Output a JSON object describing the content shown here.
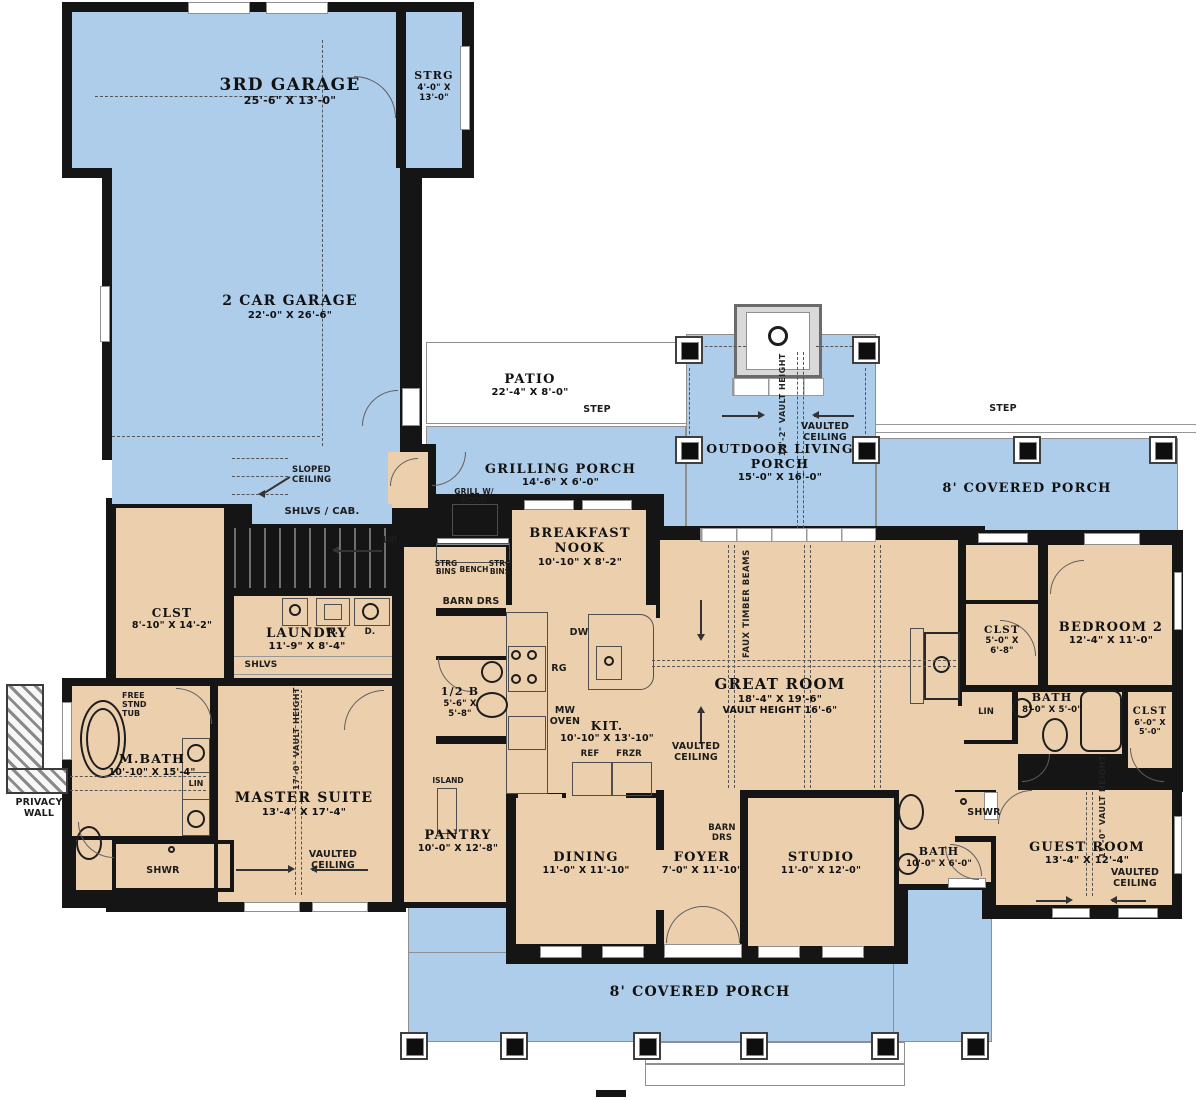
{
  "rooms": {
    "garage3": {
      "name": "3RD GARAGE",
      "dims": "25'-6\" X 13'-0\""
    },
    "strg": {
      "name": "STRG",
      "dims": "4'-0\" X 13'-0\""
    },
    "garage2": {
      "name": "2 CAR GARAGE",
      "dims": "22'-0\" X 26'-6\""
    },
    "patio": {
      "name": "PATIO",
      "dims": "22'-4\" X 8'-0\""
    },
    "grilling": {
      "name": "GRILLING PORCH",
      "dims": "14'-6\" X 6'-0\""
    },
    "outdoor": {
      "name": "OUTDOOR LIVING PORCH",
      "dims": "15'-0\" X 16'-0\""
    },
    "porch_right": {
      "name": "8' COVERED PORCH"
    },
    "porch_bottom": {
      "name": "8' COVERED PORCH"
    },
    "breakfast": {
      "name": "BREAKFAST NOOK",
      "dims": "10'-10\" X 8'-2\""
    },
    "kitchen": {
      "name": "KIT.",
      "dims": "10'-10\" X 13'-10\""
    },
    "half_bath": {
      "name": "1/2 B",
      "dims": "5'-6\" X 5'-8\""
    },
    "pantry": {
      "name": "PANTRY",
      "dims": "10'-0\" X 12'-8\""
    },
    "clst_master": {
      "name": "CLST",
      "dims": "8'-10\" X 14'-2\""
    },
    "laundry": {
      "name": "LAUNDRY",
      "dims": "11'-9\" X 8'-4\""
    },
    "mbath": {
      "name": "M.BATH",
      "dims": "10'-10\" X 15'-4\""
    },
    "master": {
      "name": "MASTER SUITE",
      "dims": "13'-4\" X 17'-4\""
    },
    "great": {
      "name": "GREAT ROOM",
      "dims": "18'-4\" X 19'-6\"",
      "note": "VAULT HEIGHT 16'-6\""
    },
    "dining": {
      "name": "DINING",
      "dims": "11'-0\" X 11'-10\""
    },
    "foyer": {
      "name": "FOYER",
      "dims": "7'-0\" X 11'-10\""
    },
    "studio": {
      "name": "STUDIO",
      "dims": "11'-0\" X 12'-0\""
    },
    "bath_studio": {
      "name": "BATH",
      "dims": "10'-0\" X 6'-0\""
    },
    "bedroom2": {
      "name": "BEDROOM 2",
      "dims": "12'-4\" X 11'-0\""
    },
    "clst_b2": {
      "name": "CLST",
      "dims": "5'-0\" X 6'-8\""
    },
    "bath2": {
      "name": "BATH",
      "dims": "8'-0\" X 5'-0\""
    },
    "clst_guest": {
      "name": "CLST",
      "dims": "6'-0\" X 5'-0\""
    },
    "guest": {
      "name": "GUEST ROOM",
      "dims": "13'-4\" X 12'-4\""
    }
  },
  "annotations": {
    "sloped_ceiling": "SLOPED CEILING",
    "shlvs_cab": "SHLVS / CAB.",
    "up": "UP",
    "shlvs": "SHLVS",
    "washer": "W.",
    "dryer": "D.",
    "free_stnd_tub": "FREE STND TUB",
    "lin": "LIN",
    "shwr": "SHWR",
    "privacy_wall": "PRIVACY WALL",
    "step": "STEP",
    "grill": "GRILL W/ HOOD",
    "strg_bins": "STRG BINS",
    "bench": "BENCH",
    "barn_drs": "BARN DRS",
    "dw": "DW",
    "rg": "RG",
    "mw_oven": "MW OVEN",
    "ref": "REF",
    "frzr": "FRZR",
    "island": "ISLAND",
    "faux_beams": "FAUX TIMBER BEAMS",
    "vaulted_ceiling": "VAULTED CEILING",
    "vault_16_2": "16'-2\" VAULT HEIGHT",
    "vault_17_0": "17'-0\" VAULT HEIGHT"
  },
  "colors": {
    "porch": "#adcdea",
    "room": "#ecd0ae",
    "wall": "#151515",
    "line": "#8f8f8f"
  }
}
